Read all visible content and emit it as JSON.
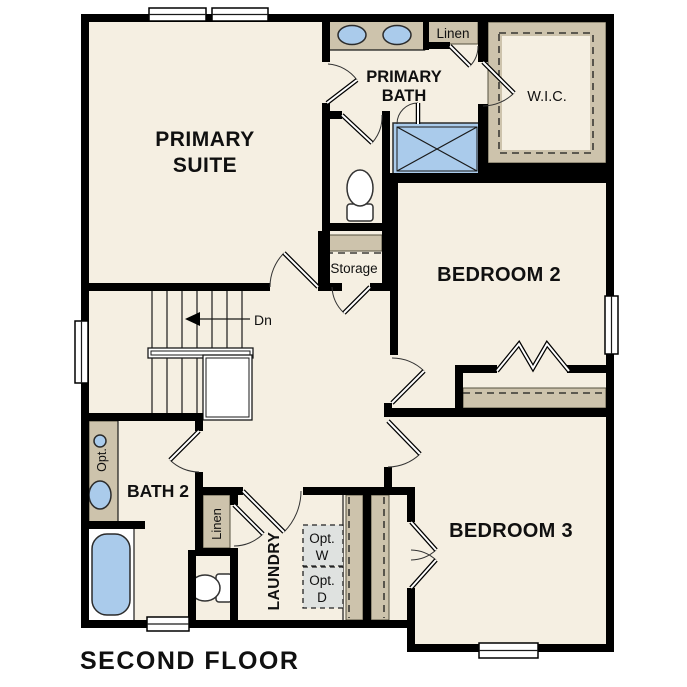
{
  "plan": {
    "title": "SECOND FLOOR",
    "colors": {
      "floor": "#f5efe2",
      "wall": "#000000",
      "cabinetry": "#cdc3ac",
      "fixture_blue": "#aacbeb",
      "appliance_gray": "#dfe2e0",
      "background": "#ffffff"
    },
    "rooms": {
      "primary_suite": {
        "line1": "PRIMARY",
        "line2": "SUITE"
      },
      "primary_bath": {
        "line1": "PRIMARY",
        "line2": "BATH"
      },
      "wic": "W.I.C.",
      "bedroom2": "BEDROOM 2",
      "bedroom3": "BEDROOM 3",
      "bath2": "BATH 2",
      "laundry": "LAUNDRY",
      "storage": "Storage",
      "linen_upper": "Linen",
      "linen_lower": "Linen"
    },
    "annotations": {
      "stair_direction": "Dn",
      "optional_sink": "Opt.",
      "optional_washer": {
        "line1": "Opt.",
        "line2": "W"
      },
      "optional_dryer": {
        "line1": "Opt.",
        "line2": "D"
      }
    }
  }
}
